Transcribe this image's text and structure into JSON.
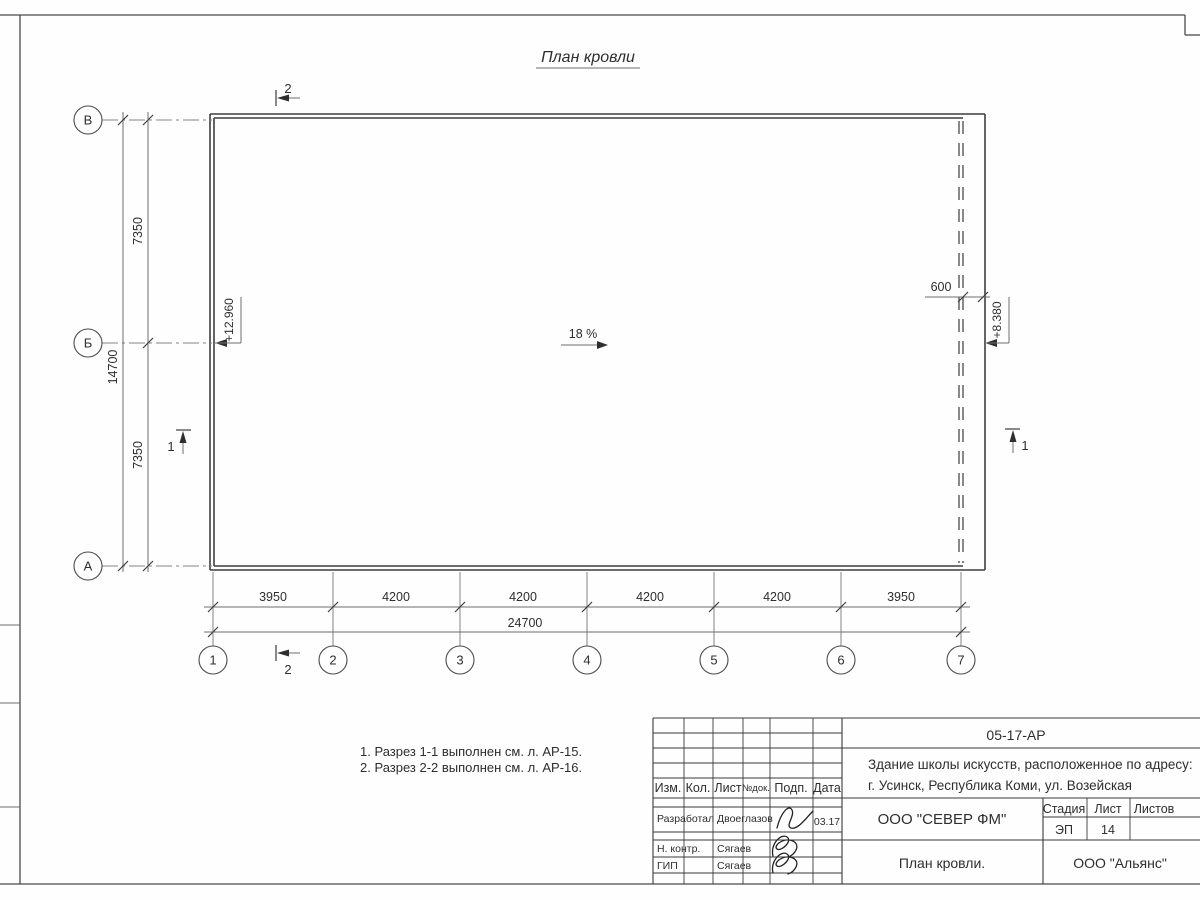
{
  "drawing": {
    "title": "План кровли",
    "slope": "18 %",
    "elevation_main": "+12.960",
    "elevation_low": "+8.380",
    "parapet_offset": "600",
    "section_1": "1",
    "section_2": "2"
  },
  "grid": {
    "row_labels": [
      "В",
      "Б",
      "А"
    ],
    "col_labels": [
      "1",
      "2",
      "3",
      "4",
      "5",
      "6",
      "7"
    ]
  },
  "dimensions": {
    "vertical_segments": [
      "7350",
      "7350"
    ],
    "vertical_total": "14700",
    "horizontal_segments": [
      "3950",
      "4200",
      "4200",
      "4200",
      "4200",
      "3950"
    ],
    "horizontal_total": "24700"
  },
  "notes": {
    "line1": "1. Разрез 1-1 выполнен см. л. АР-15.",
    "line2": "2. Разрез 2-2 выполнен см. л. АР-16."
  },
  "titleblock": {
    "doc_number": "05-17-АР",
    "object_address_line1": "Здание школы искусств, расположенное по адресу:",
    "object_address_line2": "г. Усинск, Республика Коми, ул. Возейская",
    "columns": {
      "izm": "Изм.",
      "kol": "Кол.",
      "list": "Лист",
      "ndok": "№док.",
      "podp": "Подп.",
      "data": "Дата"
    },
    "roles": {
      "developed_label": "Разработал",
      "developed_name": "Двоеглазов",
      "developed_date": "03.17",
      "ncontr_label": "Н. контр.",
      "ncontr_name": "Сягаев",
      "gip_label": "ГИП",
      "gip_name": "Сягаев"
    },
    "company": "ООО \"СЕВЕР ФМ\"",
    "stage_label": "Стадия",
    "sheet_label": "Лист",
    "sheets_label": "Листов",
    "stage_value": "ЭП",
    "sheet_value": "14",
    "sheet_title": "План кровли.",
    "contractor": "ООО \"Альянс\""
  }
}
